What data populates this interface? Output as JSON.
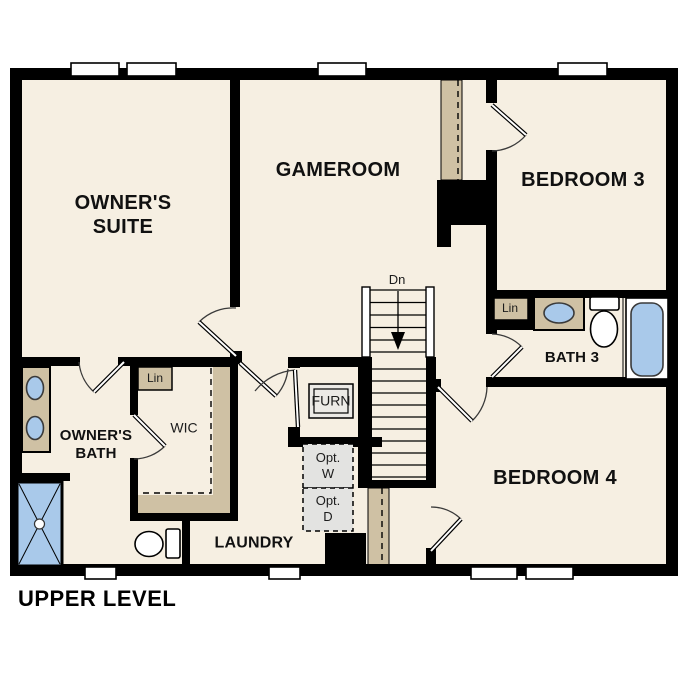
{
  "title": "UPPER LEVEL",
  "rooms": {
    "owners_suite": {
      "line1": "OWNER'S",
      "line2": "SUITE"
    },
    "gameroom": {
      "label": "GAMEROOM"
    },
    "bedroom3": {
      "label": "BEDROOM 3"
    },
    "bath3": {
      "label": "BATH 3"
    },
    "bedroom4": {
      "label": "BEDROOM 4"
    },
    "owners_bath": {
      "line1": "OWNER'S",
      "line2": "BATH"
    },
    "wic": {
      "label": "WIC"
    },
    "laundry": {
      "label": "LAUNDRY"
    }
  },
  "closets": {
    "linen_wic": {
      "label": "Lin"
    },
    "linen_bath3": {
      "label": "Lin"
    },
    "furnace": {
      "label": "FURN"
    }
  },
  "appliances": {
    "optional_washer": {
      "line1": "Opt.",
      "line2": "W"
    },
    "optional_dryer": {
      "line1": "Opt.",
      "line2": "D"
    }
  },
  "stairs": {
    "down_label": "Dn"
  },
  "colors": {
    "floor": "#f6efe2",
    "wall": "#000000",
    "cabinet_tan": "#cfc1a4",
    "fixture_blue": "#a9c9ea",
    "optional_gray": "#e3e3e1",
    "furnace_gray": "#eceae6"
  }
}
